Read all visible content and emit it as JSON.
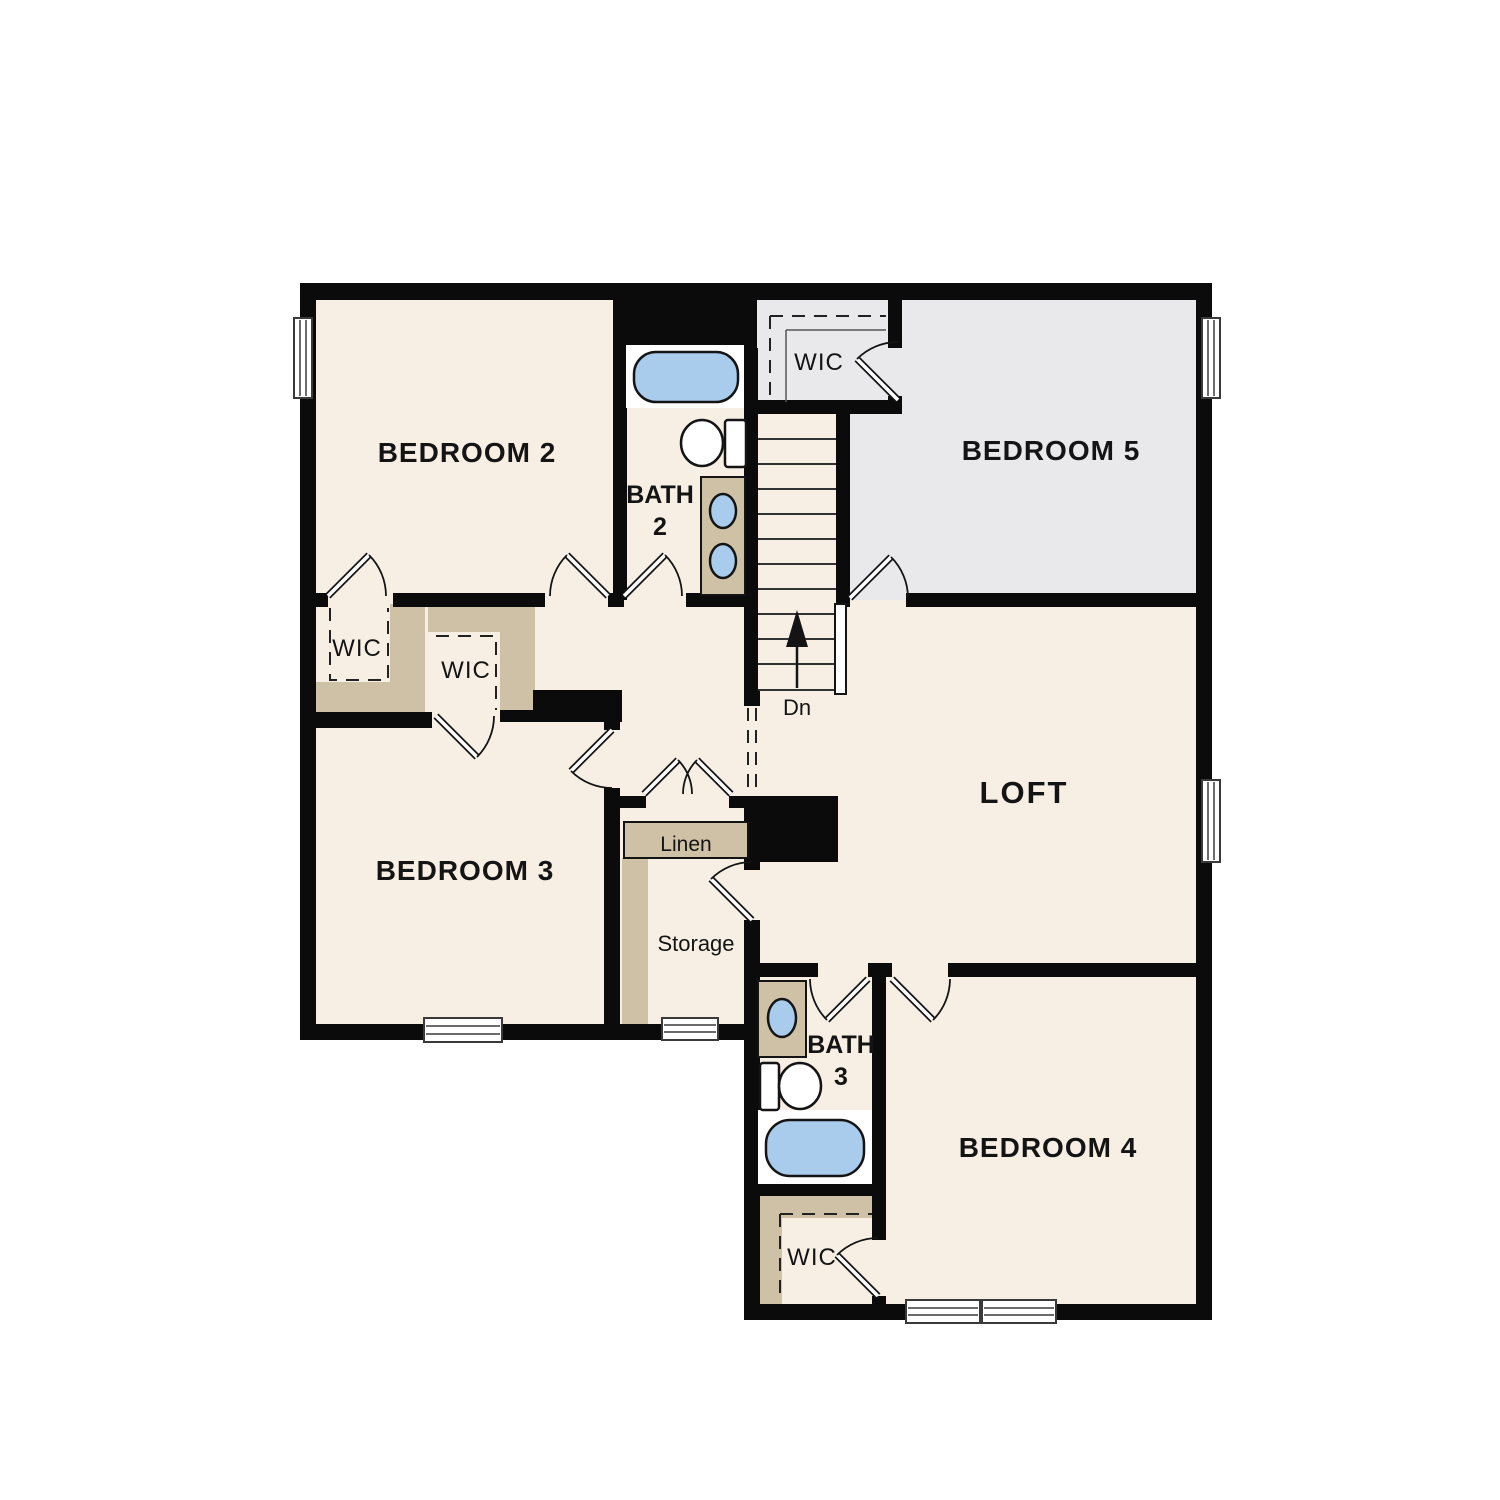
{
  "plan": {
    "type": "floor-plan",
    "colors": {
      "room": "#f8efe4",
      "alt": "#e9e9eb",
      "closet": "#cfc1a6",
      "fixture": "#a9cbec",
      "wall": "#0b0b0b"
    },
    "rooms": {
      "bedroom2": {
        "label": "BEDROOM 2"
      },
      "bedroom3": {
        "label": "BEDROOM 3"
      },
      "bedroom4": {
        "label": "BEDROOM 4"
      },
      "bedroom5": {
        "label": "BEDROOM 5"
      },
      "loft": {
        "label": "LOFT"
      },
      "bath2": {
        "name": "BATH",
        "number": "2"
      },
      "bath3": {
        "name": "BATH",
        "number": "3"
      },
      "wic_off_bedroom2": {
        "label": "WIC"
      },
      "wic_off_bedroom3": {
        "label": "WIC"
      },
      "wic_off_bedroom5": {
        "label": "WIC"
      },
      "wic_off_bedroom4": {
        "label": "WIC"
      },
      "linen": {
        "label": "Linen"
      },
      "storage": {
        "label": "Storage"
      }
    },
    "stairs": {
      "direction_label": "Dn"
    }
  }
}
